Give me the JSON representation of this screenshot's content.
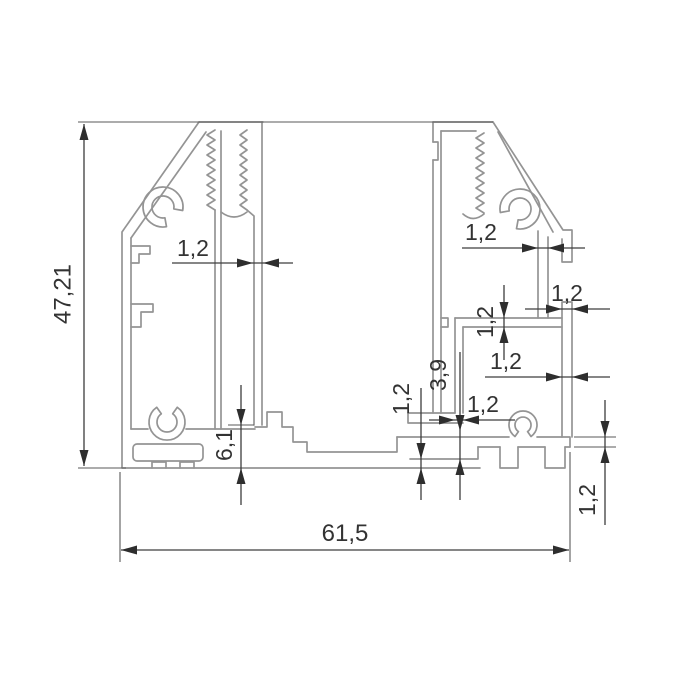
{
  "drawing": {
    "kind": "aluminium-profile-cross-section",
    "decimal_style": "comma",
    "colors": {
      "background": "#ffffff",
      "profile_line": "#949494",
      "dimension_line": "#3d3d3d",
      "text": "#333333"
    },
    "dimensions": {
      "overall_height": "47,21",
      "overall_width": "61,5",
      "left_wall_thickness": "1,2",
      "right_wall_thickness": "1,2",
      "right_tab_width": "1,2",
      "right_shelf_thickness": "1,2",
      "right_lower_wall_thickness": "1,2",
      "center_web_thickness": "1,2",
      "center_floor_thickness": "1,2",
      "base_flange_thickness": "1,2",
      "center_gap_height": "3,9",
      "foot_height": "6,1"
    }
  }
}
